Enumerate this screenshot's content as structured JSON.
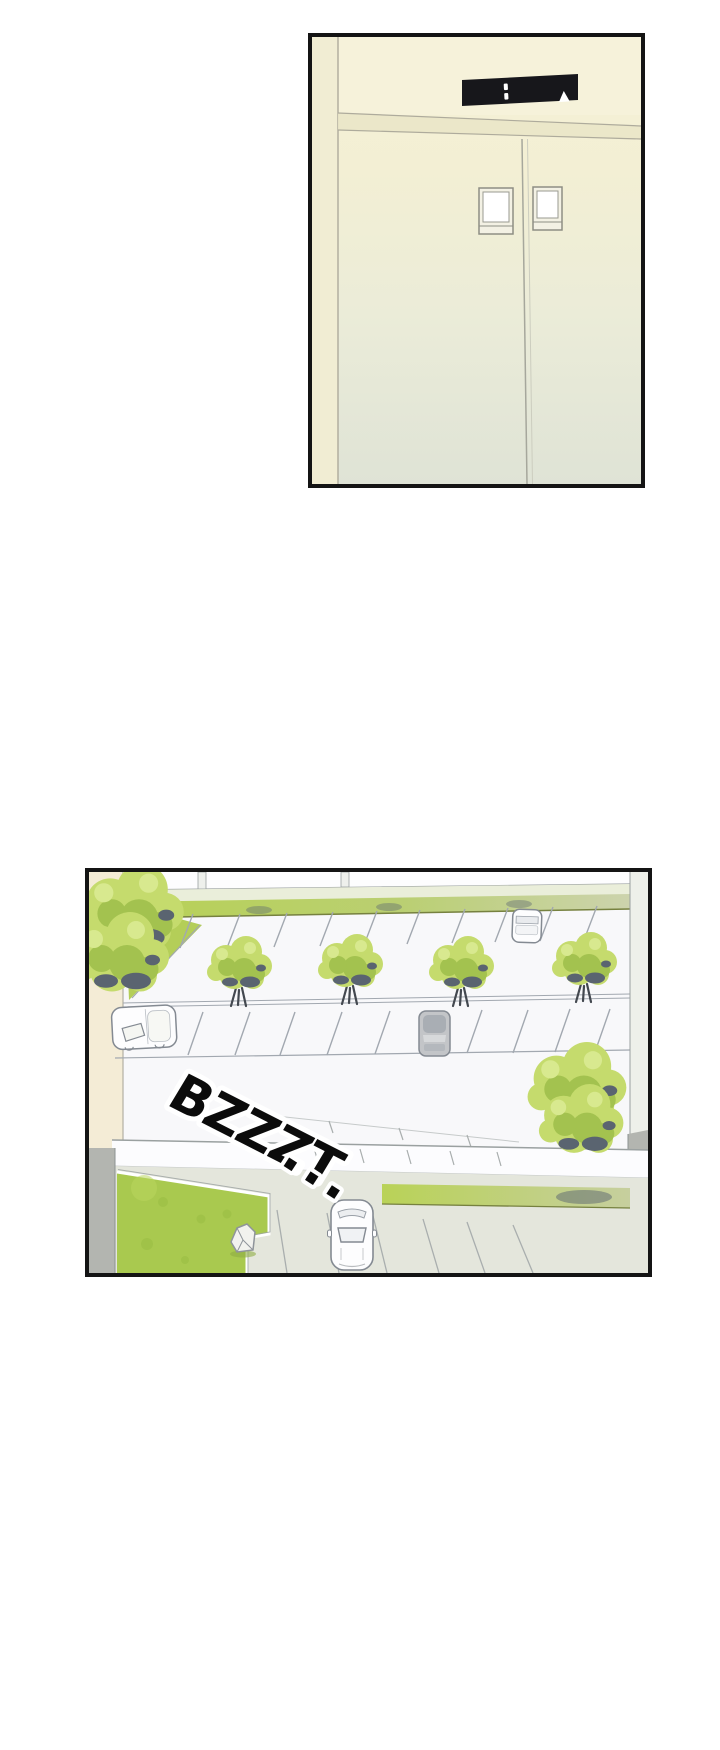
{
  "page": {
    "width": 720,
    "height": 1750,
    "background": "#ffffff"
  },
  "colors": {
    "page_bg": "#ffffff",
    "panel_border": "#141414",
    "wall_cream": "#f4f0d5",
    "lintel_band": "#eae5c8",
    "wall_line": "#aeab9c",
    "indicator_bg": "#17171b",
    "indicator_fg": "#ffffff",
    "pavement": "#f8f8fa",
    "stall_line": "#a2a8b0",
    "edge_gray": "#9aa0a0",
    "hedge_bright": "#b7d155",
    "hedge_muted": "#ccd3ad",
    "hedge_edge": "#76813f",
    "tree_light": "#c5db6d",
    "tree_mid": "#a3c24f",
    "tree_highlight": "#d8e98f",
    "tree_shadow": "#5a6470",
    "trunk": "#43484f",
    "lawn": "#a9c94f",
    "lawn_dark": "#94b83e",
    "concrete": "#e4e6dc",
    "wall_gray": "#b3b5b0",
    "warm_sliver": "#f4ecd6",
    "car_white": "#fdfdfe",
    "car_gray": "#c3c5c8",
    "car_outline": "#848a92",
    "sfx_fill": "#0b0b0b",
    "sfx_outline": "#ffffff"
  },
  "panels": {
    "elevator": {
      "indicator": {
        "arrow_glyph": "▲",
        "display_segments": 2,
        "direction": "up"
      }
    },
    "parking": {
      "sfx": {
        "text": "BZZZT",
        "ellipsis": "..."
      }
    }
  }
}
